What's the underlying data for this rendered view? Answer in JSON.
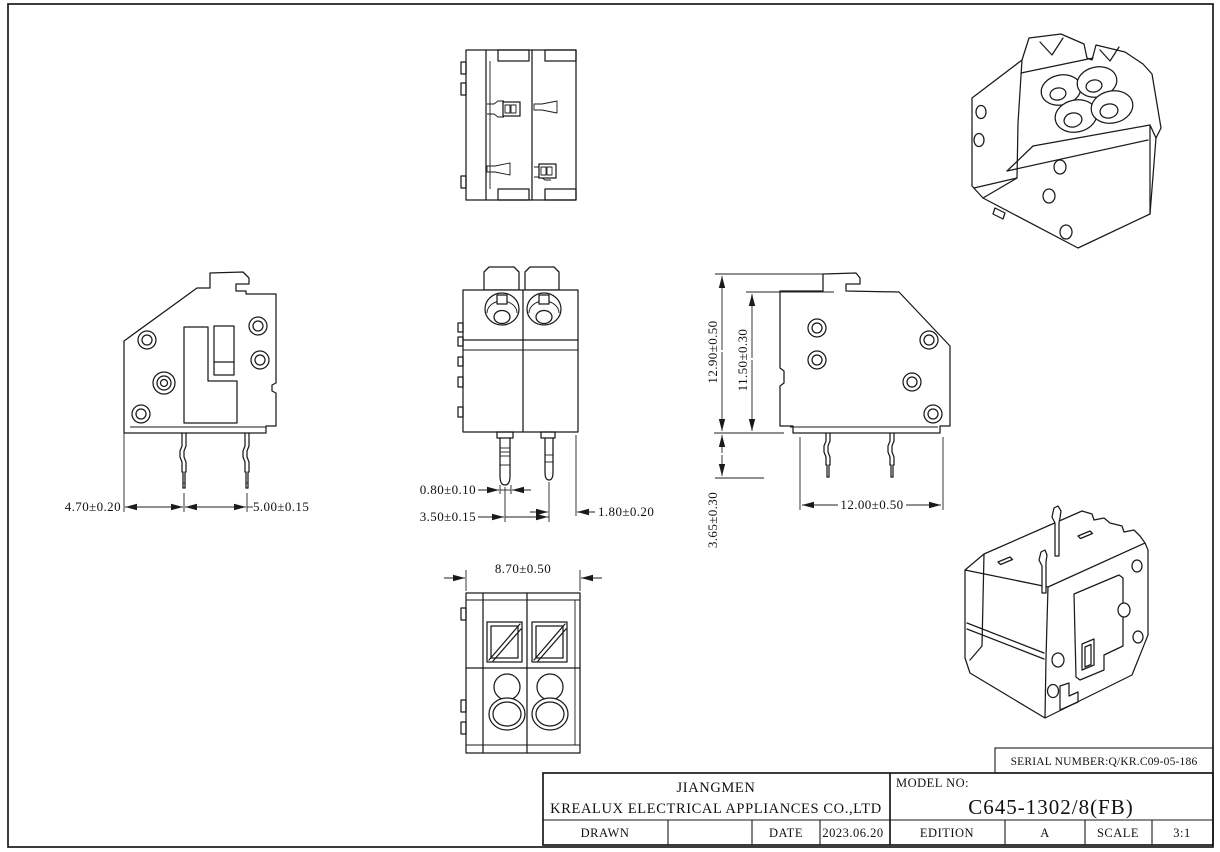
{
  "dims": {
    "d470": "4.70±0.20",
    "d500": "5.00±0.15",
    "d080": "0.80±0.10",
    "d350": "3.50±0.15",
    "d180": "1.80±0.20",
    "d870": "8.70±0.50",
    "d1290": "12.90±0.50",
    "d1150": "11.50±0.30",
    "d365": "3.65±0.30",
    "d1200": "12.00±0.50"
  },
  "title_block": {
    "serial": "SERIAL NUMBER:Q/KR.C09-05-186",
    "company_city": "JIANGMEN",
    "company_name": "KREALUX ELECTRICAL APPLIANCES CO.,LTD",
    "model_label": "MODEL NO:",
    "model_value": "C645-1302/8(FB)",
    "drawn_label": "DRAWN",
    "drawn_value": "",
    "date_label": "DATE",
    "date_value": "2023.06.20",
    "edition_label": "EDITION",
    "edition_value": "A",
    "scale_label": "SCALE",
    "scale_value": "3:1"
  }
}
